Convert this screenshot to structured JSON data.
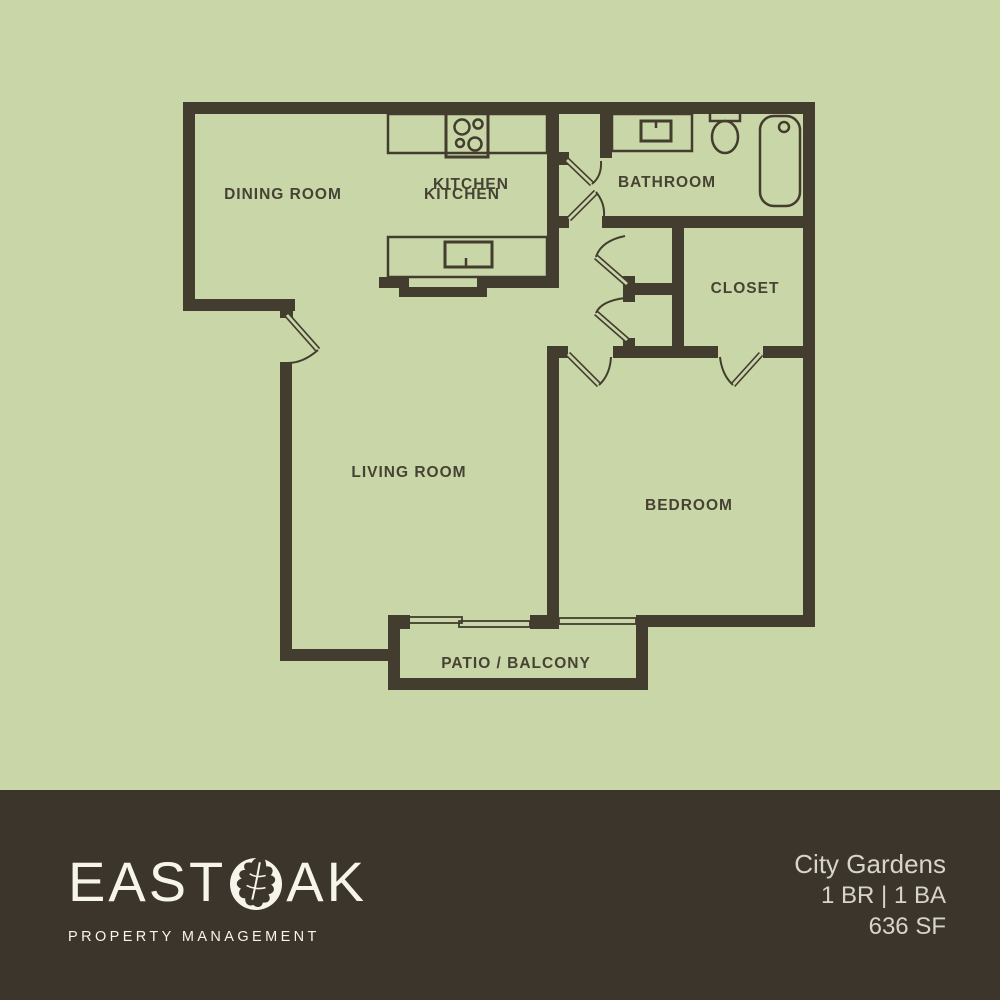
{
  "plan": {
    "rooms": {
      "dining": "DINING ROOM",
      "kitchen": "KITCHEN",
      "kitchen_overprint": "KITCHEN",
      "bathroom": "BATHROOM",
      "closet": "CLOSET",
      "living": "LIVING ROOM",
      "bedroom": "BEDROOM",
      "patio": "PATIO / BALCONY"
    }
  },
  "footer": {
    "brand_first": "EAST",
    "brand_last": "AK",
    "tagline": "PROPERTY MANAGEMENT",
    "unit": {
      "name": "City Gardens",
      "beds_baths": "1 BR | 1 BA",
      "area": "636 SF"
    }
  },
  "colors": {
    "background": "#c9d6a7",
    "wall": "#433d2f",
    "label": "#464334",
    "footer_bg": "#3b352c",
    "footer_text": "#f7f5eb",
    "footer_subtext": "#d7d5c8"
  }
}
